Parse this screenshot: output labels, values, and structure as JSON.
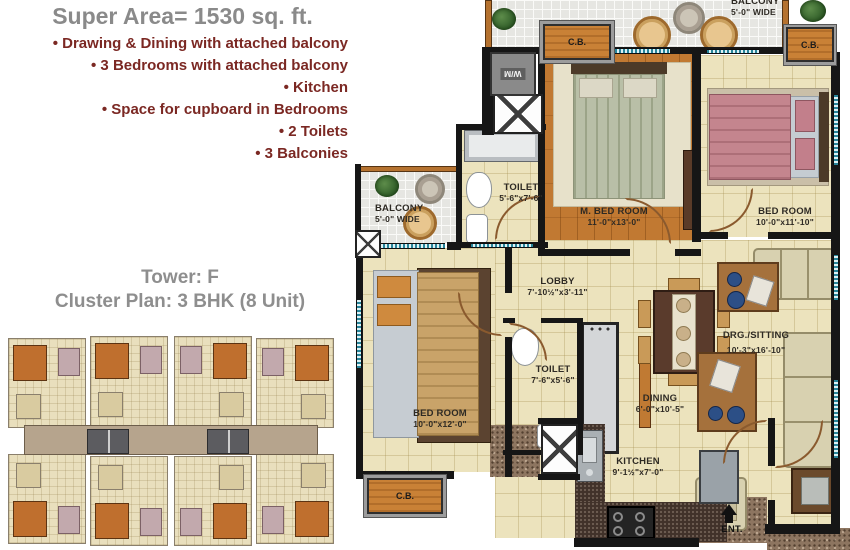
{
  "info_panel": {
    "title": "Super Area= 1530 sq. ft.",
    "features": [
      "• Drawing & Dining with attached balcony",
      "• 3 Bedrooms with attached balcony",
      "• Kitchen",
      "• Space for cupboard in Bedrooms",
      "• 2 Toilets",
      "• 3 Balconies"
    ],
    "tower": "Tower: F",
    "cluster_plan": "Cluster Plan: 3 BHK (8 Unit)"
  },
  "floor_plan": {
    "rooms": {
      "master_bedroom": {
        "name": "M. BED ROOM",
        "dims": "11'-0\"x13'-0\""
      },
      "bedroom_right": {
        "name": "BED ROOM",
        "dims": "10'-0\"x11'-10\""
      },
      "bedroom_left": {
        "name": "BED ROOM",
        "dims": "10'-0\"x12'-0\""
      },
      "toilet_top": {
        "name": "TOILET",
        "dims": "5'-6\"x7'-6\""
      },
      "toilet_mid": {
        "name": "TOILET",
        "dims": "7'-6\"x5'-6\""
      },
      "lobby": {
        "name": "LOBBY",
        "dims": "7'-10½\"x3'-11\""
      },
      "drg_sitting": {
        "name": "DRG./SITTING",
        "dims": "10'-3\"x16'-10\""
      },
      "dining": {
        "name": "DINING",
        "dims": "6'-0\"x10'-5\""
      },
      "kitchen": {
        "name": "KITCHEN",
        "dims": "9'-1½\"x7'-0\""
      },
      "balcony_left": {
        "name": "BALCONY",
        "dims": "5'-0\" WIDE"
      },
      "balcony_top": {
        "name": "BALCONY",
        "dims": "5'-0\" WIDE"
      }
    },
    "labels": {
      "cupboard": "C.B.",
      "washing_machine": "W/M",
      "entrance": "ENT."
    }
  },
  "colors": {
    "title_gray": "#8a8a8a",
    "feature_maroon": "#7b2823",
    "floor_cream": "#ece3bd",
    "wood_orange": "#c17932",
    "wall_black": "#161616",
    "window_teal": "#27859a",
    "cupboard_orange": "#c98136",
    "bed_pink": "#c4858e",
    "sofa_beige": "#d8d1b0"
  }
}
